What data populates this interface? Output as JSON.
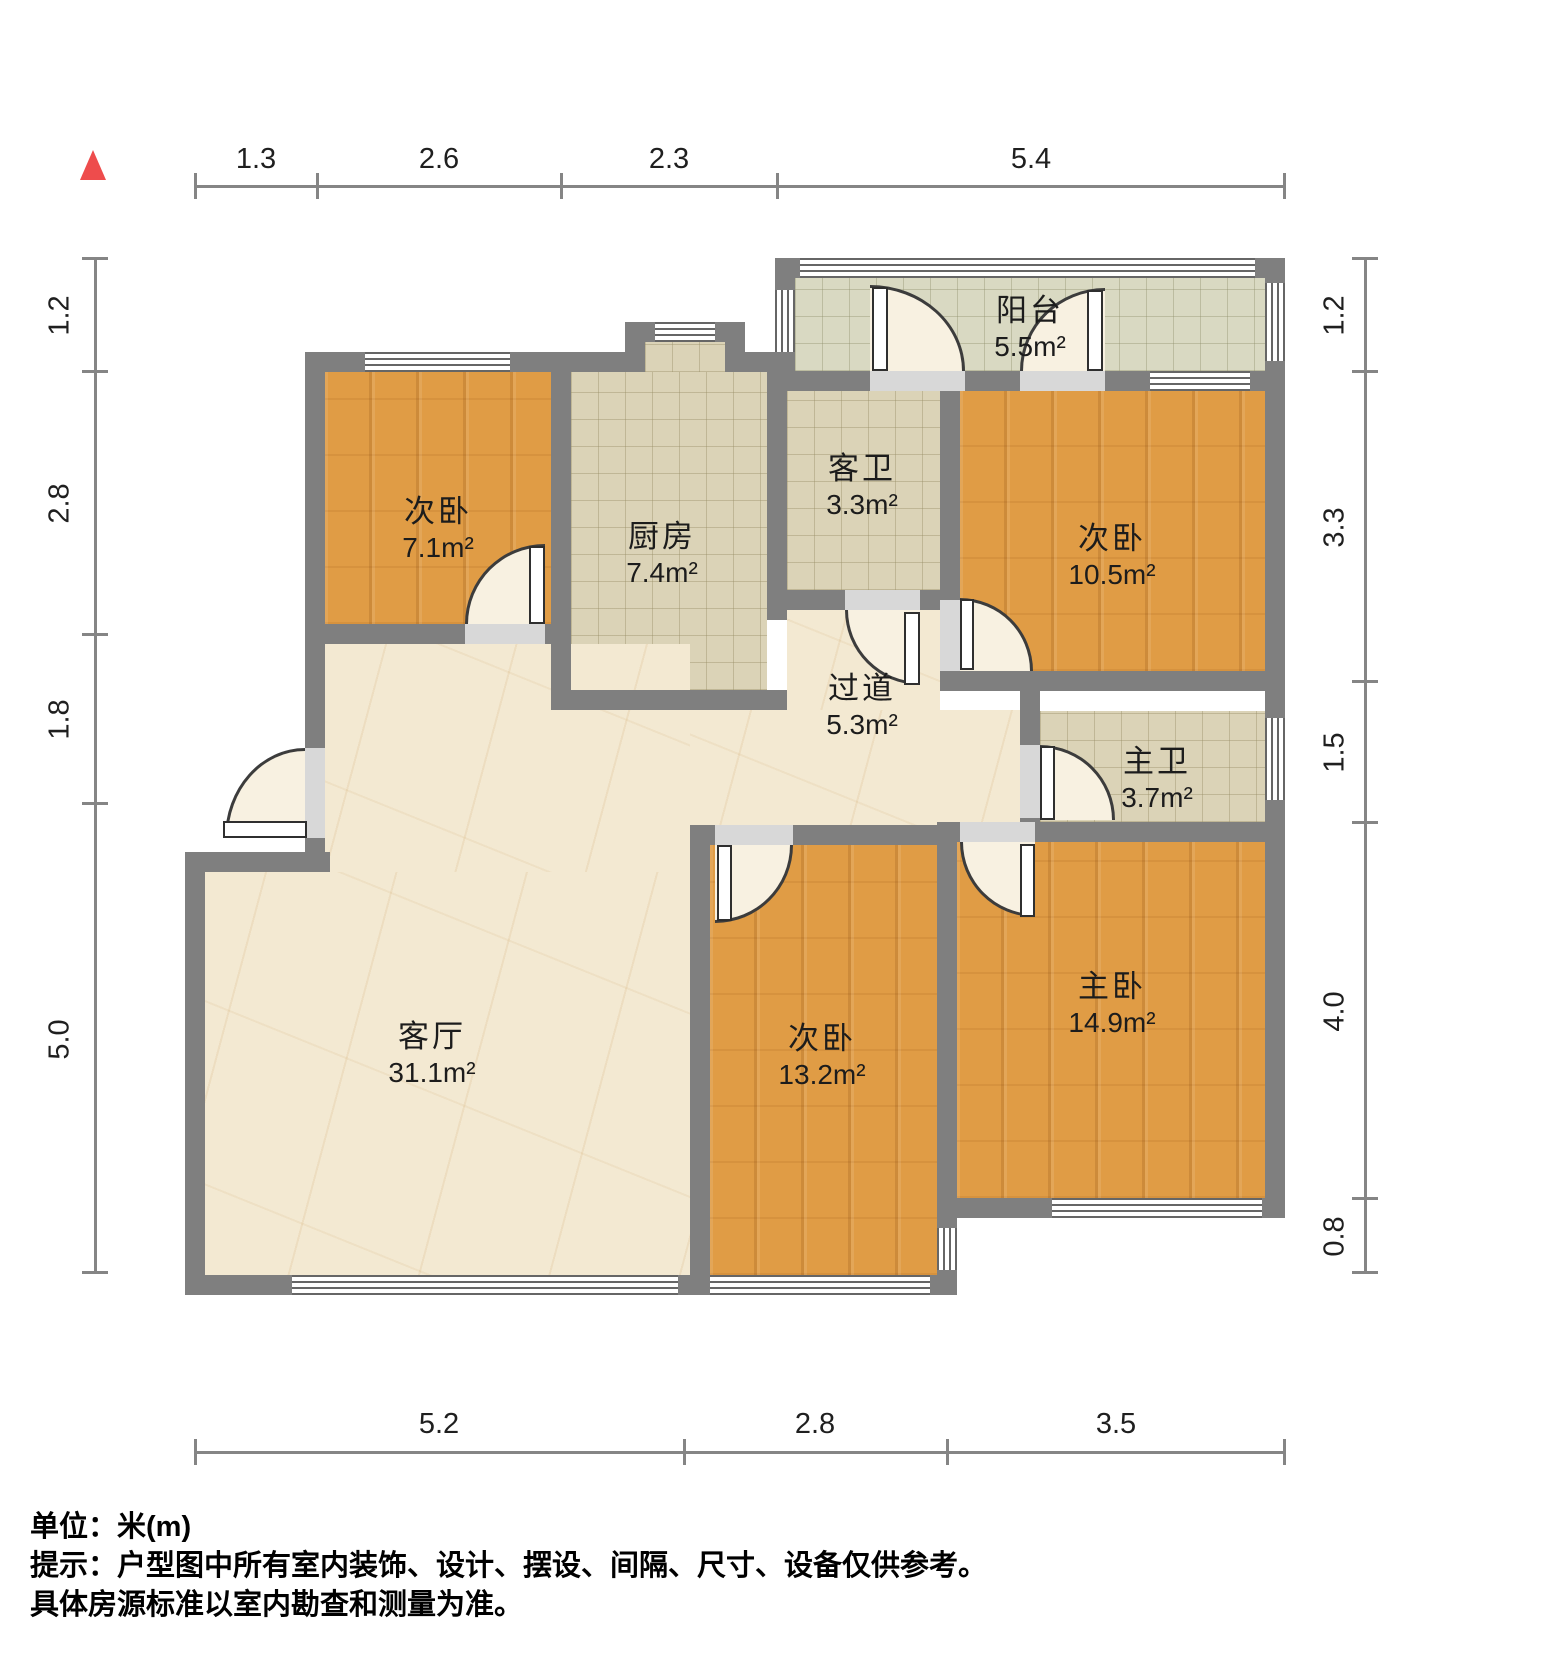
{
  "rooms": [
    {
      "name": "阳台",
      "area": "5.5m²"
    },
    {
      "name": "次卧",
      "area": "7.1m²"
    },
    {
      "name": "厨房",
      "area": "7.4m²"
    },
    {
      "name": "客卫",
      "area": "3.3m²"
    },
    {
      "name": "次卧",
      "area": "10.5m²"
    },
    {
      "name": "过道",
      "area": "5.3m²"
    },
    {
      "name": "主卫",
      "area": "3.7m²"
    },
    {
      "name": "客厅",
      "area": "31.1m²"
    },
    {
      "name": "次卧",
      "area": "13.2m²"
    },
    {
      "name": "主卧",
      "area": "14.9m²"
    }
  ],
  "dimensions": {
    "top": [
      "1.3",
      "2.6",
      "2.3",
      "5.4"
    ],
    "left": [
      "1.2",
      "2.8",
      "1.8",
      "5.0"
    ],
    "right": [
      "1.2",
      "3.3",
      "1.5",
      "4.0",
      "0.8"
    ],
    "bottom": [
      "5.2",
      "2.8",
      "3.5"
    ]
  },
  "footer": {
    "unit_line": "单位：米(m)",
    "note_line1": "提示：户型图中所有室内装饰、设计、摆设、间隔、尺寸、设备仅供参考。",
    "note_line2": "具体房源标准以室内勘查和测量为准。"
  },
  "colors": {
    "wall": "#7f7f7f",
    "wood_floor": "#e09c45",
    "tile_floor": "#dbd3b7",
    "balcony_floor": "#d9d9c2",
    "marble_floor": "#f3e9d2",
    "north_arrow": "#ee4c4c"
  }
}
